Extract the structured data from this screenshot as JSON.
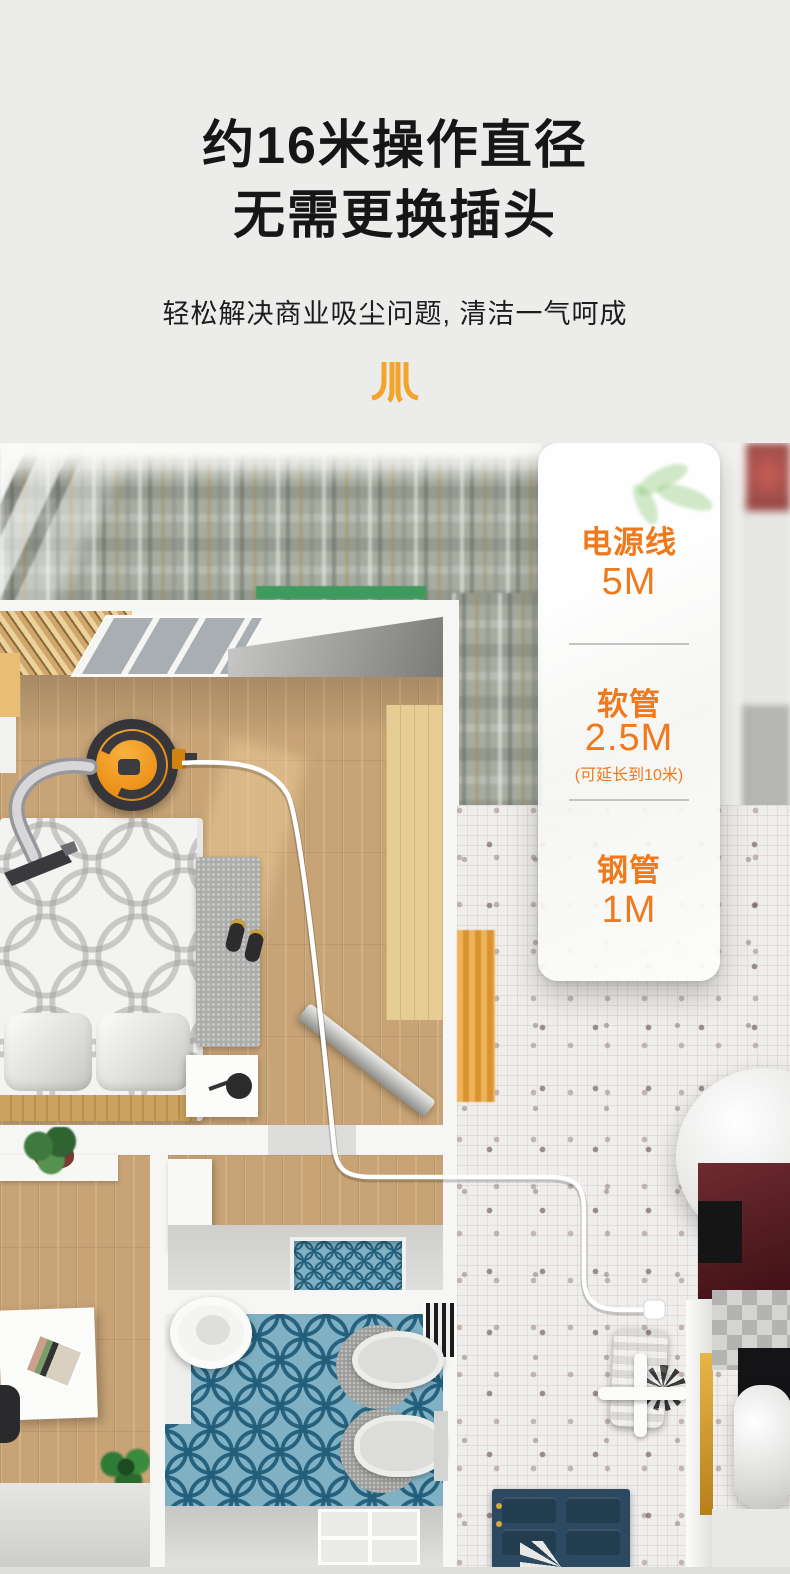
{
  "page": {
    "background": "#ececea",
    "width": 790,
    "height": 1574
  },
  "header": {
    "title_line1": "约16米操作直径",
    "title_line2": "无需更换插头",
    "subtitle": "轻松解决商业吸尘问题, 清洁一气呵成",
    "title_color": "#161616",
    "brand_mark_color": "#f2a42d"
  },
  "spec_card": {
    "accent_color": "#f0791c",
    "items": [
      {
        "label": "电源线",
        "value": "5M",
        "note": ""
      },
      {
        "label": "软管",
        "value": "2.5M",
        "note": "(可延长到10米)"
      },
      {
        "label": "钢管",
        "value": "1M",
        "note": ""
      }
    ]
  },
  "floorplan": {
    "alt": "公寓顶视图：卧室内吸尘器的电源线穿过房间连接到插座",
    "colors": {
      "wood_floor": "#c7a376",
      "mosaic_tile": "#f0eeec",
      "bath_tile_blue": "#7fb0c4",
      "vacuum_orange": "#f0941e",
      "door_navy": "#2b4960",
      "power_cord": "#ffffff"
    }
  }
}
